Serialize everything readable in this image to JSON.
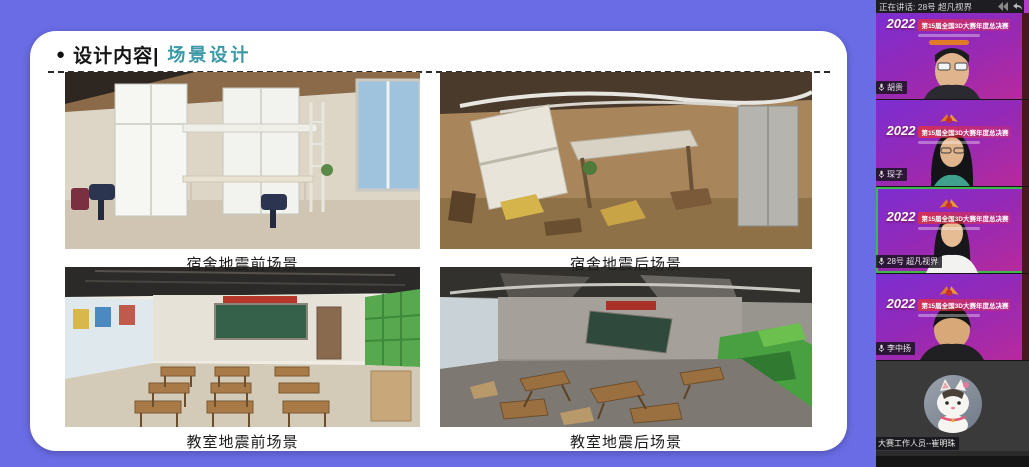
{
  "slide": {
    "bullet": "●",
    "title": "设计内容|",
    "subtitle": "场景设计",
    "figures": [
      {
        "caption": "宿舍地震前场景"
      },
      {
        "caption": "宿舍地震后场景"
      },
      {
        "caption": "教室地震前场景"
      },
      {
        "caption": "教室地震后场景"
      }
    ],
    "colors": {
      "background": "#6a6ce6",
      "card": "#ffffff",
      "subtitle_accent": "#3b98a6"
    }
  },
  "sidebar": {
    "status": {
      "speaking": "正在讲话: 28号 超凡视界"
    },
    "banner": {
      "year": "2022",
      "title": "第15届全国3D大赛年度总决赛"
    },
    "participants": [
      {
        "name": "胡贵"
      },
      {
        "name": "琛子"
      },
      {
        "name": "28号 超凡视界",
        "speaking": true
      },
      {
        "name": "李中扬"
      },
      {
        "name": "大赛工作人员--崔明珠"
      }
    ],
    "colors": {
      "active_border": "#3db84a",
      "panel": "#151515"
    }
  }
}
